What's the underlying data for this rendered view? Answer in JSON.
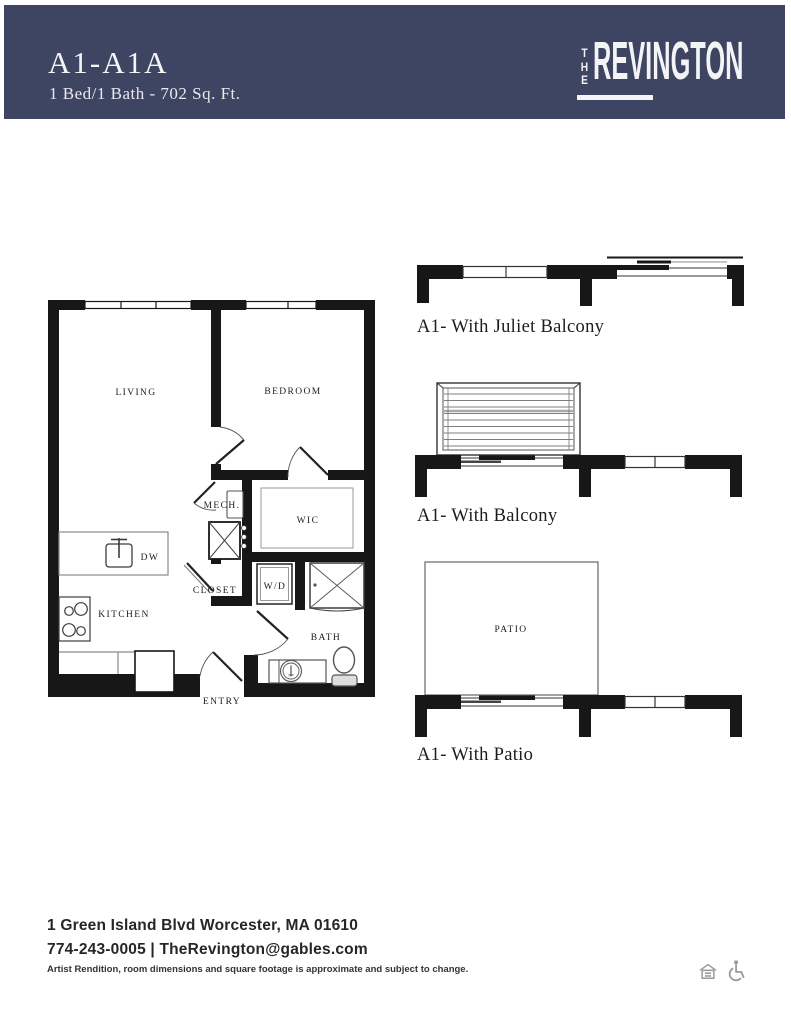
{
  "header": {
    "title": "A1-A1A",
    "subtitle": "1 Bed/1 Bath - 702 Sq. Ft.",
    "brand_the_letters": {
      "t": "T",
      "h": "H",
      "e": "E"
    },
    "brand_name": "REVINGTON"
  },
  "floor_plan": {
    "labels": {
      "living": "LIVING",
      "bedroom": "BEDROOM",
      "mech": "MECH.",
      "wic": "WIC",
      "dw": "DW",
      "closet": "CLOSET",
      "wd": "W/D",
      "kitchen": "KITCHEN",
      "bath": "BATH",
      "entry": "ENTRY"
    }
  },
  "variants": {
    "juliet": {
      "caption": "A1- With Juliet Balcony"
    },
    "balcony": {
      "caption": "A1- With Balcony"
    },
    "patio": {
      "caption": "A1- With Patio",
      "label": "PATIO"
    }
  },
  "footer": {
    "address": "1 Green Island Blvd Worcester, MA 01610",
    "contact": "774-243-0005 | TheRevington@gables.com",
    "disclaimer": "Artist Rendition, room dimensions and square footage is approximate and subject to change.",
    "icons": [
      "equal-housing-icon",
      "wheelchair-icon"
    ]
  },
  "colors": {
    "header_bg": "#3e4563",
    "header_text": "#f4f4f6",
    "wall": "#171717",
    "label": "#1b1b1b",
    "icon_gray": "#9b9b9b"
  }
}
